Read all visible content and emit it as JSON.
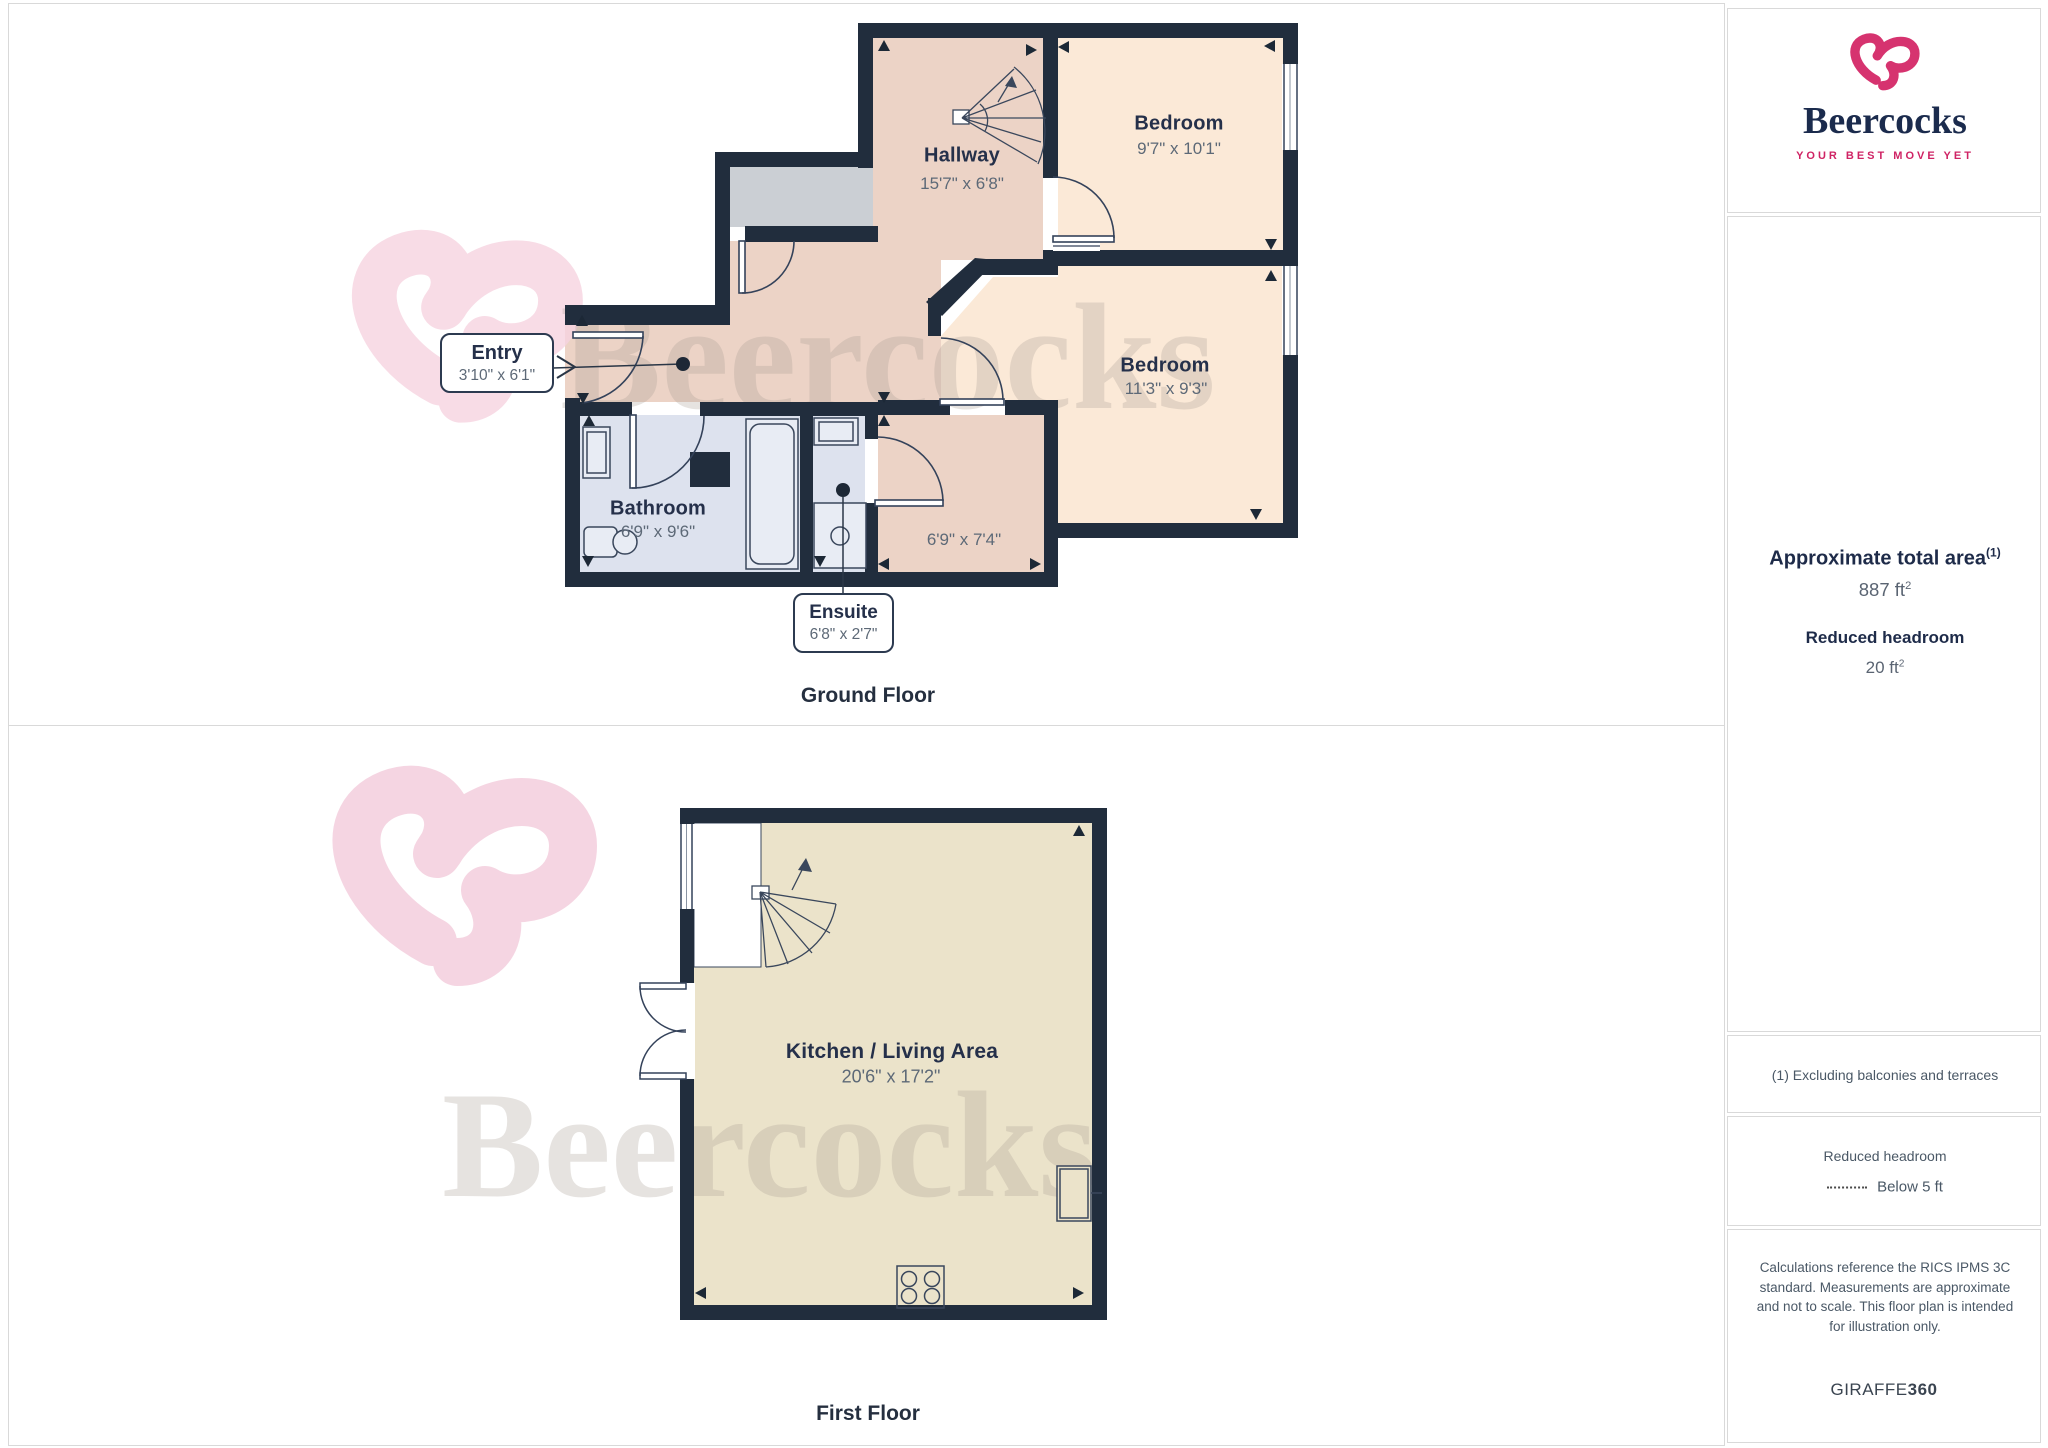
{
  "brand": {
    "name": "Beercocks",
    "tagline": "YOUR BEST MOVE YET"
  },
  "watermark": {
    "text": "Beercocks"
  },
  "ground_floor": {
    "title": "Ground Floor",
    "rooms": {
      "hallway": {
        "label": "Hallway",
        "dims": "15'7\" x 6'8\""
      },
      "bedroom1": {
        "label": "Bedroom",
        "dims": "9'7\" x 10'1\""
      },
      "bedroom2": {
        "label": "Bedroom",
        "dims": "11'3\" x 9'3\""
      },
      "bathroom": {
        "label": "Bathroom",
        "dims": "6'9\" x 9'6\""
      },
      "lobby": {
        "dims": "6'9\" x 7'4\""
      }
    },
    "callouts": {
      "entry": {
        "label": "Entry",
        "dims": "3'10\" x 6'1\""
      },
      "ensuite": {
        "label": "Ensuite",
        "dims": "6'8\" x 2'7\""
      }
    }
  },
  "first_floor": {
    "title": "First Floor",
    "rooms": {
      "kitchen_living": {
        "label": "Kitchen / Living Area",
        "dims": "20'6\" x 17'2\""
      }
    }
  },
  "sidebar": {
    "area_title": "Approximate total area",
    "area_footnote_marker": "(1)",
    "area_value": "887 ft",
    "area_value_sup": "2",
    "headroom_title": "Reduced headroom",
    "headroom_value": "20 ft",
    "headroom_value_sup": "2",
    "footnote": "(1) Excluding balconies and terraces",
    "legend_title": "Reduced headroom",
    "legend_label": "Below 5 ft",
    "disclaimer": "Calculations reference the RICS IPMS 3C standard. Measurements are approximate and not to scale. This floor plan is intended for illustration only.",
    "credit_prefix": "GIRAFFE",
    "credit_suffix": "360"
  },
  "colors": {
    "wall": "#212d3d",
    "hall_pink": "#ecd3c6",
    "bedroom_cream": "#fbe9d7",
    "bath_blue": "#dde2ee",
    "kitchen_beige": "#ebe3ca",
    "cupboard_gray": "#cbcfd4",
    "brand_pink": "#d6336f",
    "brand_navy": "#1b2b4d",
    "tagline_pink": "#cf2364"
  }
}
